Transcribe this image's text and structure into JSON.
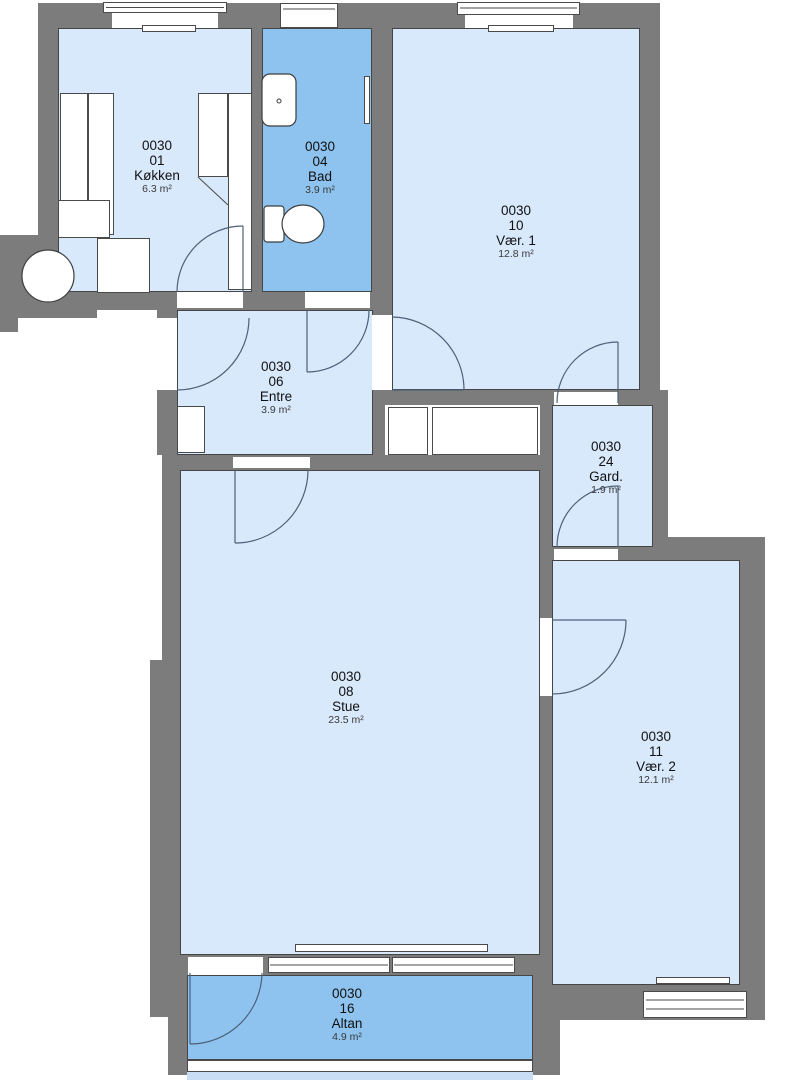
{
  "colors": {
    "wall": "#7c7c7c",
    "room_light": "#d9e9fc",
    "room_medium": "#8dc3ee",
    "balcony_edge": "#c9def5",
    "outline": "#4a4a4a",
    "door_arc": "#4d6078"
  },
  "rooms": [
    {
      "key": "koekken",
      "code": "0030",
      "number": "01",
      "name": "Køkken",
      "area": "6.3 m²"
    },
    {
      "key": "bad",
      "code": "0030",
      "number": "04",
      "name": "Bad",
      "area": "3.9 m²"
    },
    {
      "key": "vaer1",
      "code": "0030",
      "number": "10",
      "name": "Vær. 1",
      "area": "12.8 m²"
    },
    {
      "key": "entre",
      "code": "0030",
      "number": "06",
      "name": "Entre",
      "area": "3.9 m²"
    },
    {
      "key": "gard",
      "code": "0030",
      "number": "24",
      "name": "Gard.",
      "area": "1.9 m²"
    },
    {
      "key": "stue",
      "code": "0030",
      "number": "08",
      "name": "Stue",
      "area": "23.5 m²"
    },
    {
      "key": "vaer2",
      "code": "0030",
      "number": "11",
      "name": "Vær. 2",
      "area": "12.1 m²"
    },
    {
      "key": "altan",
      "code": "0030",
      "number": "16",
      "name": "Altan",
      "area": "4.9 m²"
    }
  ],
  "fixtures": [
    "sink-icon",
    "toilet-icon",
    "stair-core-icon",
    "radiator-icon",
    "window-icon",
    "door-swing-icon"
  ]
}
